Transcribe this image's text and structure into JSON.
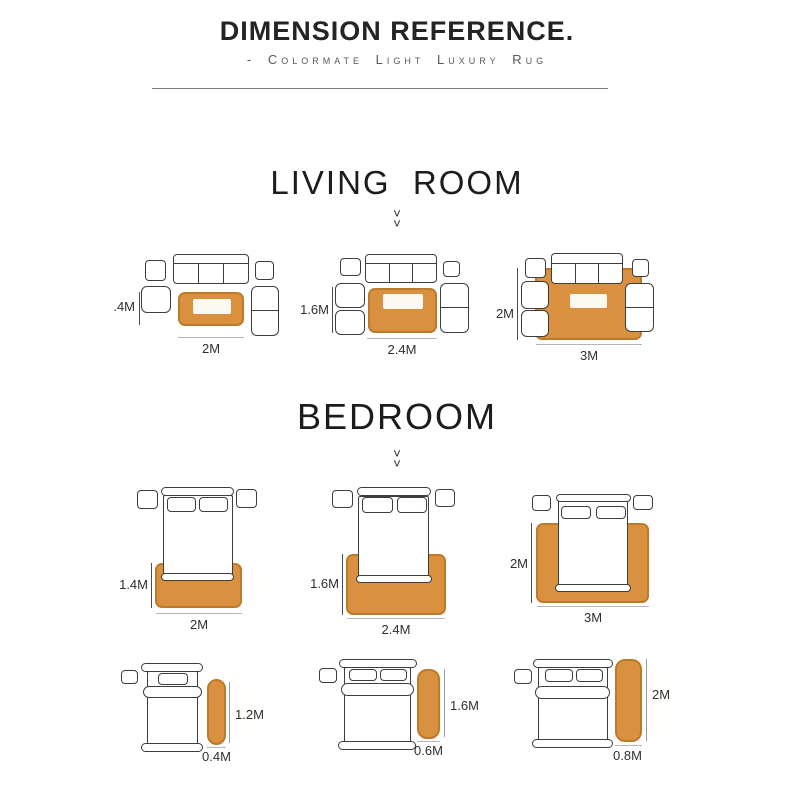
{
  "header": {
    "title": "DIMENSION REFERENCE.",
    "subtitle": "- Colormate Light Luxury Rug"
  },
  "icons": {
    "double_down_chevron": "˅\n˅"
  },
  "colors": {
    "rug_fill": "#D9913F",
    "rug_border": "#BD7A2A",
    "furniture_outline": "#3D3D3D",
    "dimension_line_dark": "#4D4D4D",
    "dimension_line_light": "#B5B5B5"
  },
  "living_room": {
    "title": "LIVING  ROOM",
    "layouts": [
      {
        "height_label": ".4M",
        "width_label": "2M"
      },
      {
        "height_label": "1.6M",
        "width_label": "2.4M"
      },
      {
        "height_label": "2M",
        "width_label": "3M"
      }
    ]
  },
  "bedroom": {
    "title": "BEDROOM",
    "layouts": [
      {
        "height_label": "1.4M",
        "width_label": "2M"
      },
      {
        "height_label": "1.6M",
        "width_label": "2.4M"
      },
      {
        "height_label": "2M",
        "width_label": "3M"
      }
    ],
    "runner_layouts": [
      {
        "height_label": "1.2M",
        "width_label": "0.4M"
      },
      {
        "height_label": "1.6M",
        "width_label": "0.6M"
      },
      {
        "height_label": "2M",
        "width_label": "0.8M"
      }
    ]
  }
}
